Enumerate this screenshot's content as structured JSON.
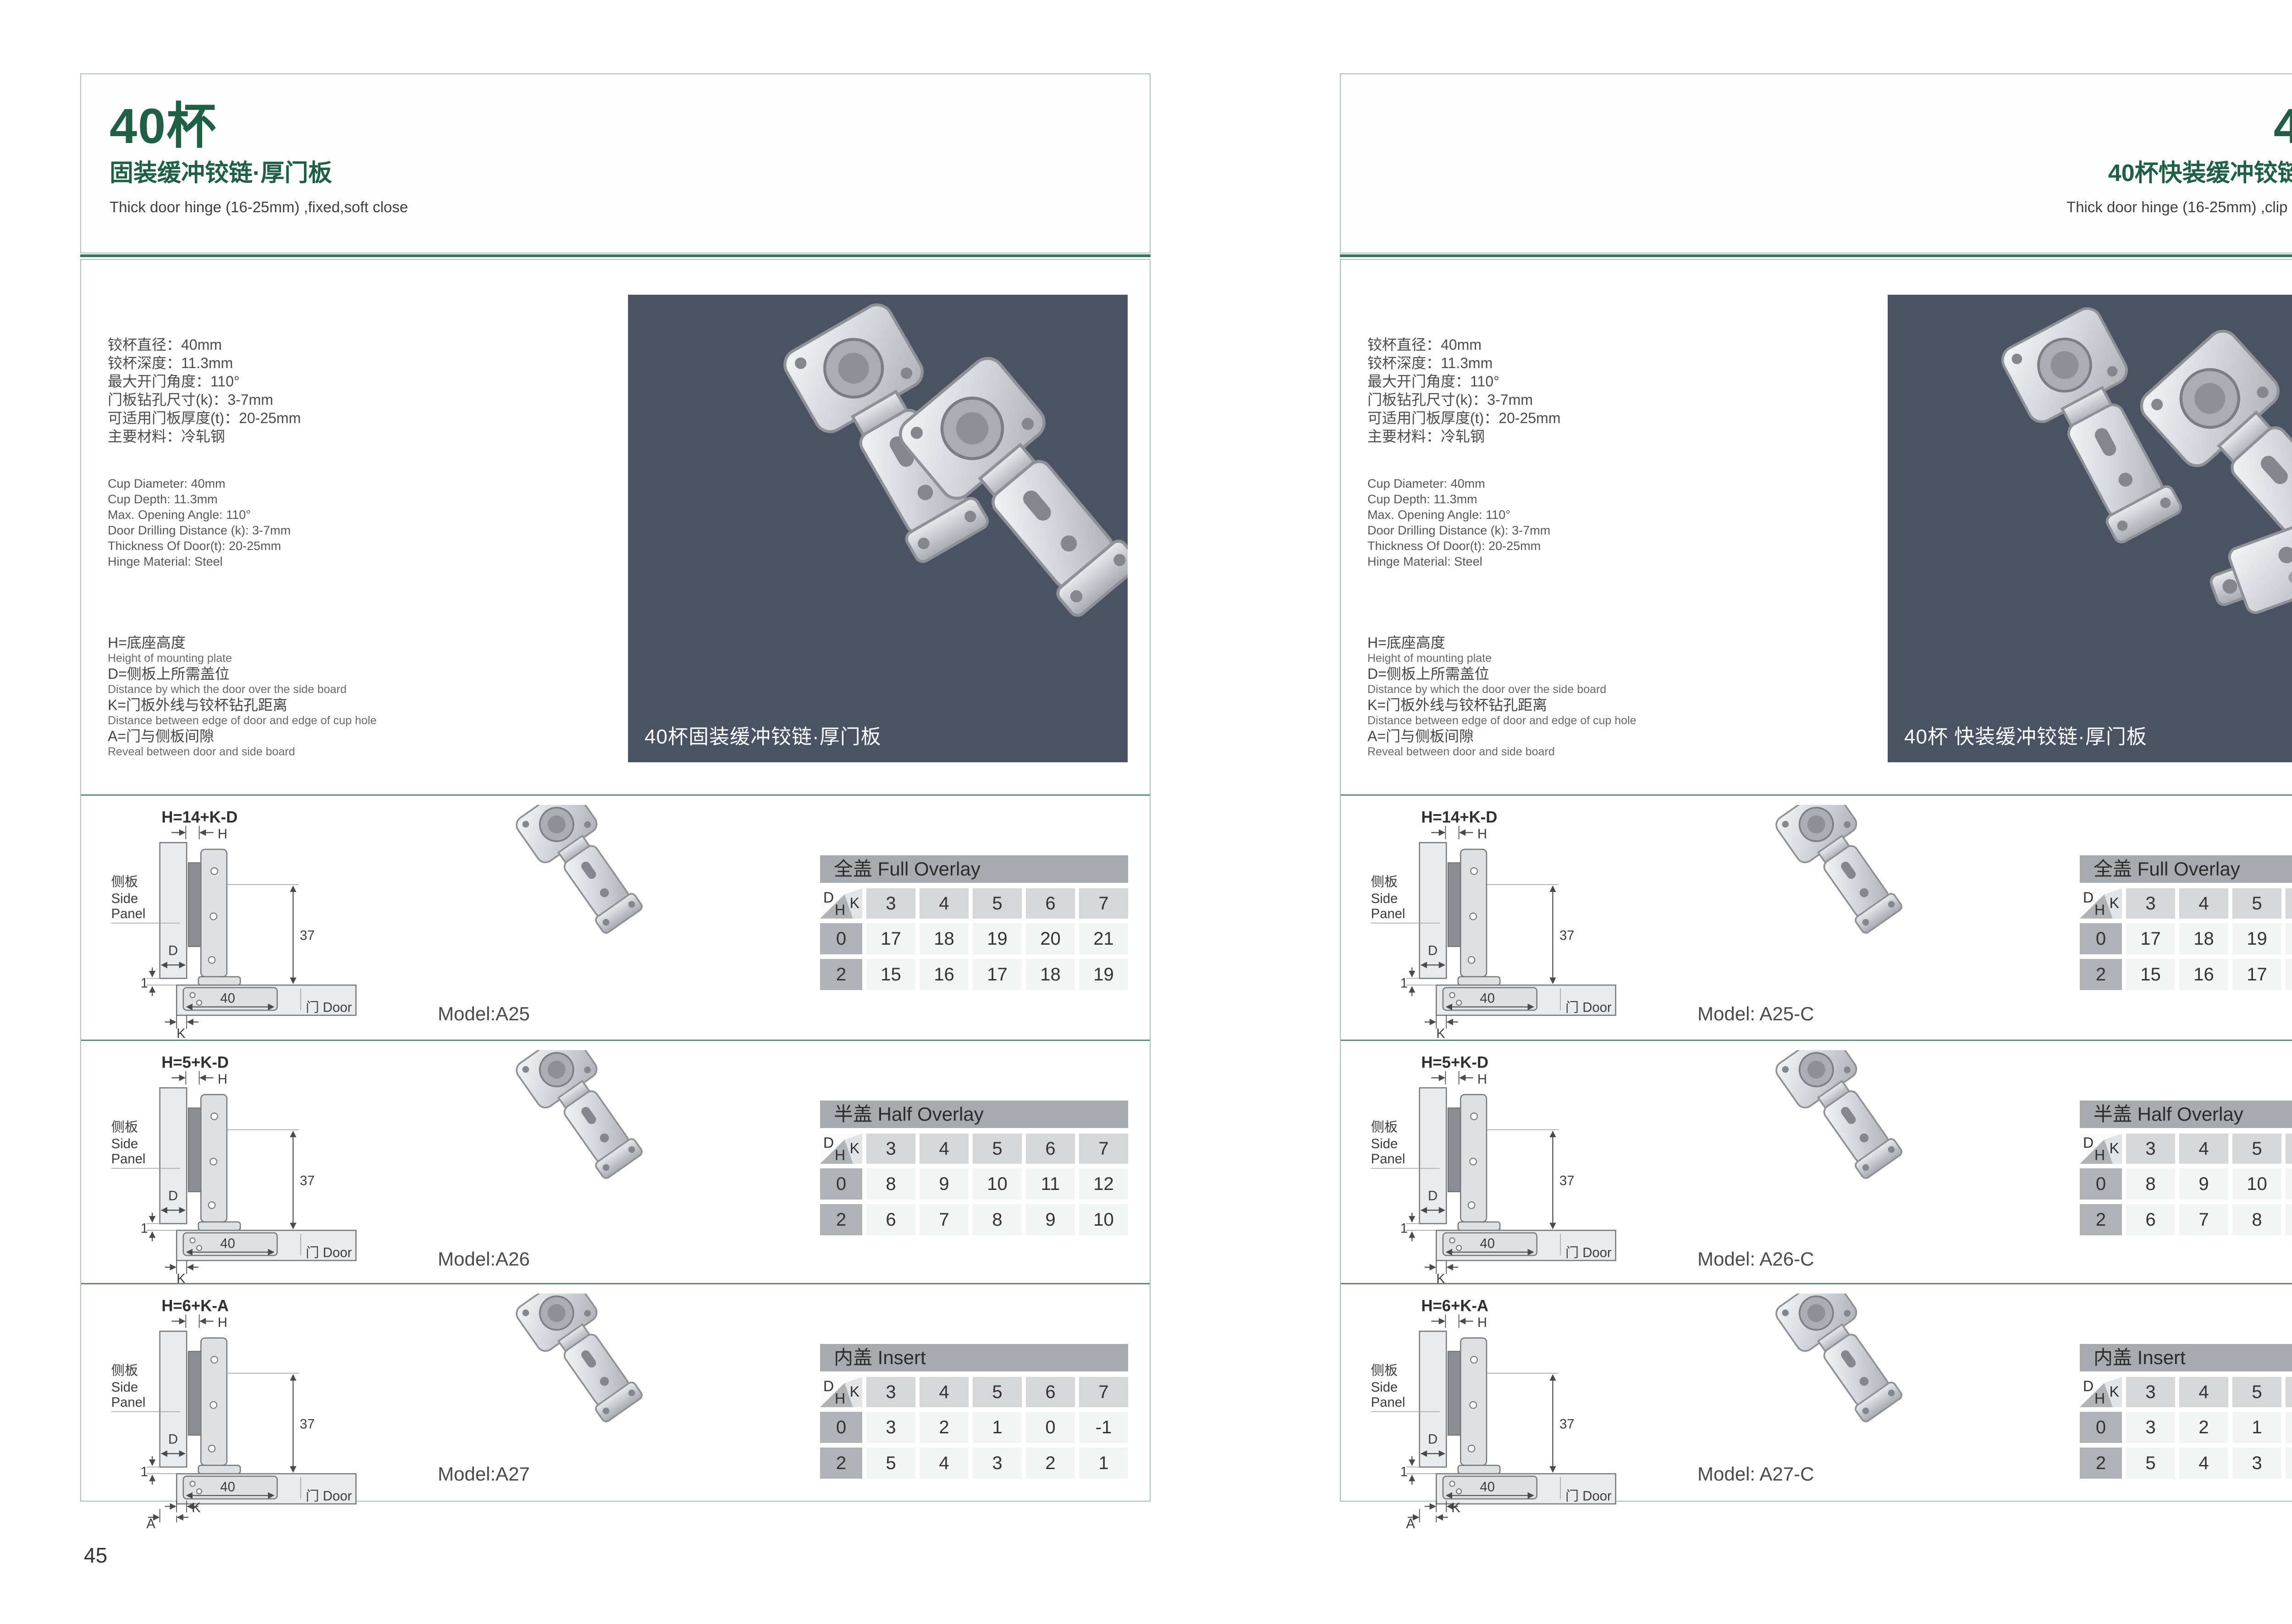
{
  "colors": {
    "title_green": "#1f5f45",
    "line_green": "#407259",
    "row_separator_green": "#5d8f74",
    "box_border": "#a9c2b3",
    "photo_background": "#4a5263",
    "table_title_bg": "#a8abad",
    "k_header_bg": "#d6d7d8",
    "h_header_bg": "#b0b3b5",
    "value_cell_bg": "#f3f4f4"
  },
  "specs": {
    "cn": [
      "铰杯直径：40mm",
      "铰杯深度：11.3mm",
      "最大开门角度：110°",
      "门板钻孔尺寸(k)：3-7mm",
      "可适用门板厚度(t)：20-25mm",
      "主要材料：冷轧钢"
    ],
    "en": [
      "Cup Diameter: 40mm",
      "Cup Depth: 11.3mm",
      "Max. Opening Angle: 110°",
      "Door Drilling Distance (k): 3-7mm",
      "Thickness Of Door(t): 20-25mm",
      "Hinge Material: Steel"
    ]
  },
  "definitions": [
    {
      "cn": "H=底座高度",
      "en": "Height of mounting plate"
    },
    {
      "cn": "D=侧板上所需盖位",
      "en": "Distance by which the door over the side board"
    },
    {
      "cn": "K=门板外线与铰杯钻孔距离",
      "en": "Distance between edge of door and edge of cup hole"
    },
    {
      "cn": "A=门与侧板间隙",
      "en": "Reveal between door and side board"
    }
  ],
  "diagram": {
    "h": "H",
    "d": "D",
    "k": "K",
    "a": "A",
    "dim_37": "37",
    "dim_40": "40",
    "dim_1": "1",
    "side_panel_cn": "侧板",
    "side_panel_en1": "Side",
    "side_panel_en2": "Panel",
    "door_label": "门 Door"
  },
  "table_shared": {
    "corner_d": "D",
    "corner_k": "K",
    "corner_h": "H",
    "k_values": [
      "3",
      "4",
      "5",
      "6",
      "7"
    ],
    "h_values": [
      "0",
      "2"
    ]
  },
  "pages": [
    {
      "page_number": "45",
      "title": "40杯",
      "subtitle": "固装缓冲铰链·厚门板",
      "subtitle_en": "Thick door hinge (16-25mm) ,fixed,soft close",
      "photo_caption": "40杯固装缓冲铰链·厚门板",
      "rows": [
        {
          "formula": "H=14+K-D",
          "model": "Model:A25",
          "table": {
            "title": "全盖 Full Overlay",
            "row0": [
              "17",
              "18",
              "19",
              "20",
              "21"
            ],
            "row2": [
              "15",
              "16",
              "17",
              "18",
              "19"
            ]
          }
        },
        {
          "formula": "H=5+K-D",
          "model": "Model:A26",
          "table": {
            "title": "半盖 Half Overlay",
            "row0": [
              "8",
              "9",
              "10",
              "11",
              "12"
            ],
            "row2": [
              "6",
              "7",
              "8",
              "9",
              "10"
            ]
          }
        },
        {
          "formula": "H=6+K-A",
          "model": "Model:A27",
          "table": {
            "title": "内盖 Insert",
            "row0": [
              "3",
              "2",
              "1",
              "0",
              "-1"
            ],
            "row2": [
              "5",
              "4",
              "3",
              "2",
              "1"
            ]
          }
        }
      ]
    },
    {
      "page_number": "46",
      "title": "40杯",
      "subtitle": "40杯快装缓冲铰链·厚门板",
      "subtitle_en": "Thick door hinge (16-25mm) ,clip on ,soft close",
      "photo_caption": "40杯 快装缓冲铰链·厚门板",
      "rows": [
        {
          "formula": "H=14+K-D",
          "model": "Model: A25-C",
          "table": {
            "title": "全盖 Full Overlay",
            "row0": [
              "17",
              "18",
              "19",
              "20",
              "21"
            ],
            "row2": [
              "15",
              "16",
              "17",
              "18",
              "19"
            ]
          }
        },
        {
          "formula": "H=5+K-D",
          "model": "Model: A26-C",
          "table": {
            "title": "半盖 Half Overlay",
            "row0": [
              "8",
              "9",
              "10",
              "11",
              "12"
            ],
            "row2": [
              "6",
              "7",
              "8",
              "9",
              "10"
            ]
          }
        },
        {
          "formula": "H=6+K-A",
          "model": "Model: A27-C",
          "table": {
            "title": "内盖 Insert",
            "row0": [
              "3",
              "2",
              "1",
              "0",
              "-1"
            ],
            "row2": [
              "5",
              "4",
              "3",
              "2",
              "1"
            ]
          }
        }
      ]
    }
  ]
}
